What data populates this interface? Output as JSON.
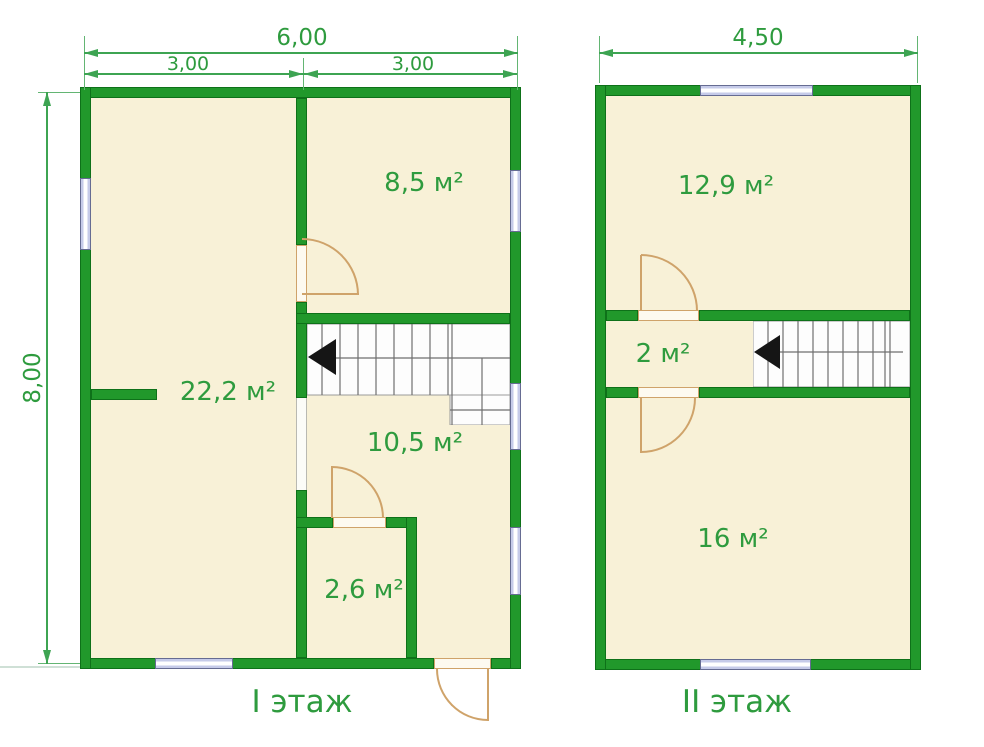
{
  "colors": {
    "wall_green": "#21982b",
    "wall_edge": "#0e7119",
    "room_fill": "#f8f1d7",
    "dimension_green": "#3da452",
    "text_green": "#2e9b3e",
    "door_tan": "#cfa36a",
    "window_glass": "#c6cbe9",
    "window_frame": "#666c92",
    "stair_line": "#6f6f6f",
    "stair_arrow": "#151515"
  },
  "floor1": {
    "name": "I этаж",
    "dims": {
      "total_width": "6,00",
      "left_half": "3,00",
      "right_half": "3,00",
      "height": "8,00"
    },
    "rooms": [
      {
        "area": "8,5 м²"
      },
      {
        "area": "22,2 м²"
      },
      {
        "area": "10,5 м²"
      },
      {
        "area": "2,6 м²"
      }
    ]
  },
  "floor2": {
    "name": "II этаж",
    "dims": {
      "total_width": "4,50"
    },
    "rooms": [
      {
        "area": "12,9 м²"
      },
      {
        "area": "2 м²"
      },
      {
        "area": "16 м²"
      }
    ]
  }
}
